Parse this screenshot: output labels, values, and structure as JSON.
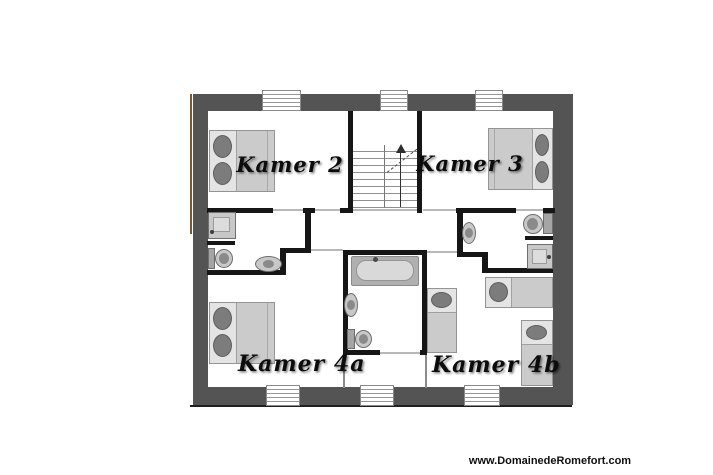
{
  "rooms": [
    {
      "id": "kamer-2",
      "label": "Kamer 2"
    },
    {
      "id": "kamer-3",
      "label": "Kamer 3"
    },
    {
      "id": "kamer-4a",
      "label": "Kamer 4a"
    },
    {
      "id": "kamer-4b",
      "label": "Kamer 4b"
    }
  ],
  "watermark": "www.DomainedeRomefort.com",
  "colors": {
    "outer_wall": "#545454",
    "interior_wall": "#161616",
    "door_line": "#b8b8b8",
    "furniture_fill": "#cbcbcb",
    "pillow": "#7c7c7c",
    "wood_edge": "#7a5a35",
    "background": "#ffffff"
  },
  "icons": {
    "double_bed": "rect with two dark oval pillows",
    "single_bed": "rect with one dark oval pillow",
    "bathtub": "rounded rect in grey surround with faucet dot",
    "toilet": "tank rect plus oval bowl",
    "sink": "oval basin with dark centre",
    "shower": "square tray with drain dot",
    "staircase": "two stepped flights with up arrow and dashed cut line",
    "window": "striped gap in outer wall"
  }
}
